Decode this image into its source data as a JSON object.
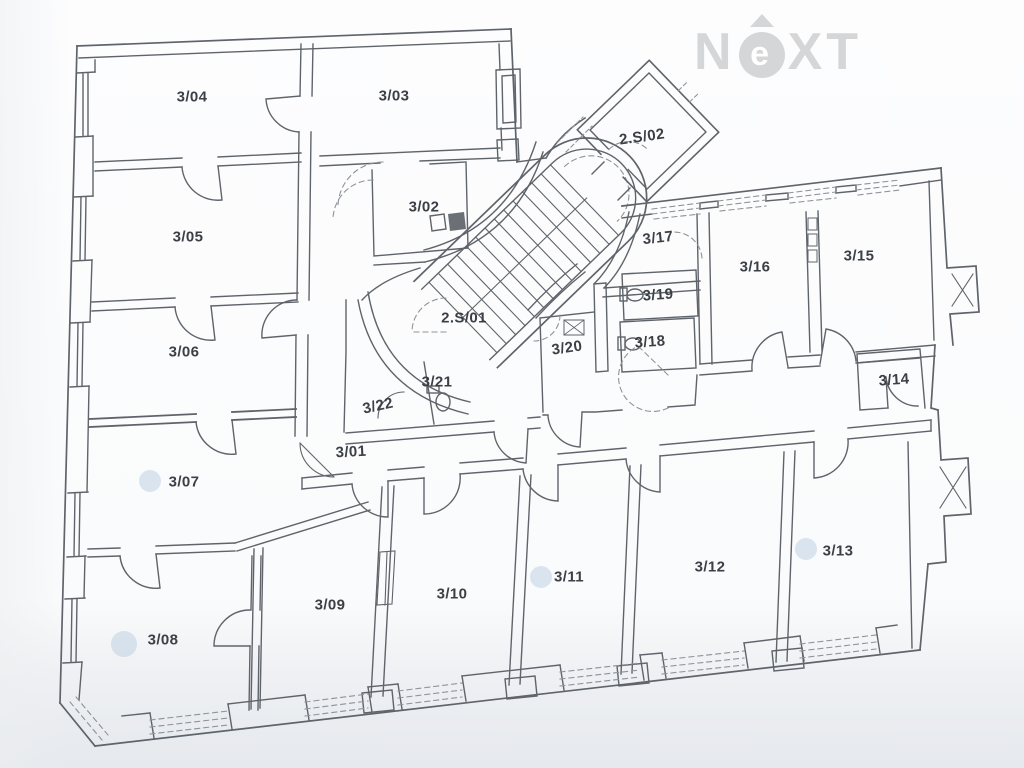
{
  "logo": {
    "n": "N",
    "e": "e",
    "xt": "XT",
    "name": "NEXT"
  },
  "plan": {
    "title": "floor plan – 3rd level",
    "rooms": [
      {
        "id": "3/04",
        "x": 192,
        "y": 97,
        "rot": 0
      },
      {
        "id": "3/03",
        "x": 394,
        "y": 96,
        "rot": 0
      },
      {
        "id": "2.S/02",
        "x": 642,
        "y": 137,
        "rot": -8
      },
      {
        "id": "3/05",
        "x": 188,
        "y": 237,
        "rot": 0
      },
      {
        "id": "3/02",
        "x": 424,
        "y": 207,
        "rot": 0
      },
      {
        "id": "3/17",
        "x": 658,
        "y": 238,
        "rot": -6
      },
      {
        "id": "3/16",
        "x": 755,
        "y": 267,
        "rot": 0
      },
      {
        "id": "3/15",
        "x": 859,
        "y": 256,
        "rot": 0
      },
      {
        "id": "2.S/01",
        "x": 464,
        "y": 318,
        "rot": 0
      },
      {
        "id": "3/19",
        "x": 658,
        "y": 295,
        "rot": -4
      },
      {
        "id": "3/18",
        "x": 650,
        "y": 342,
        "rot": -4
      },
      {
        "id": "3/20",
        "x": 567,
        "y": 348,
        "rot": -8
      },
      {
        "id": "3/06",
        "x": 184,
        "y": 352,
        "rot": 0
      },
      {
        "id": "3/21",
        "x": 437,
        "y": 382,
        "rot": 0
      },
      {
        "id": "3/22",
        "x": 378,
        "y": 406,
        "rot": -12
      },
      {
        "id": "3/14",
        "x": 894,
        "y": 380,
        "rot": -4
      },
      {
        "id": "3/01",
        "x": 351,
        "y": 452,
        "rot": -3
      },
      {
        "id": "3/07",
        "x": 184,
        "y": 482,
        "rot": 0
      },
      {
        "id": "3/13",
        "x": 838,
        "y": 551,
        "rot": 0
      },
      {
        "id": "3/12",
        "x": 710,
        "y": 567,
        "rot": 0
      },
      {
        "id": "3/11",
        "x": 569,
        "y": 577,
        "rot": 0
      },
      {
        "id": "3/10",
        "x": 452,
        "y": 594,
        "rot": 0
      },
      {
        "id": "3/09",
        "x": 330,
        "y": 605,
        "rot": 0
      },
      {
        "id": "3/08",
        "x": 163,
        "y": 640,
        "rot": 0
      }
    ],
    "markers": [
      {
        "x": 150,
        "y": 481,
        "r": 11
      },
      {
        "x": 124,
        "y": 644,
        "r": 13
      },
      {
        "x": 541,
        "y": 577,
        "r": 11
      },
      {
        "x": 806,
        "y": 549,
        "r": 11
      }
    ]
  },
  "colors": {
    "line": "#5f646b",
    "dashed": "#8f949a",
    "label": "#3b4046",
    "marker": "#b9cde0",
    "logo": "#d5d6d7",
    "paper": "#fcfcfd",
    "shade": "#e7eaee"
  }
}
